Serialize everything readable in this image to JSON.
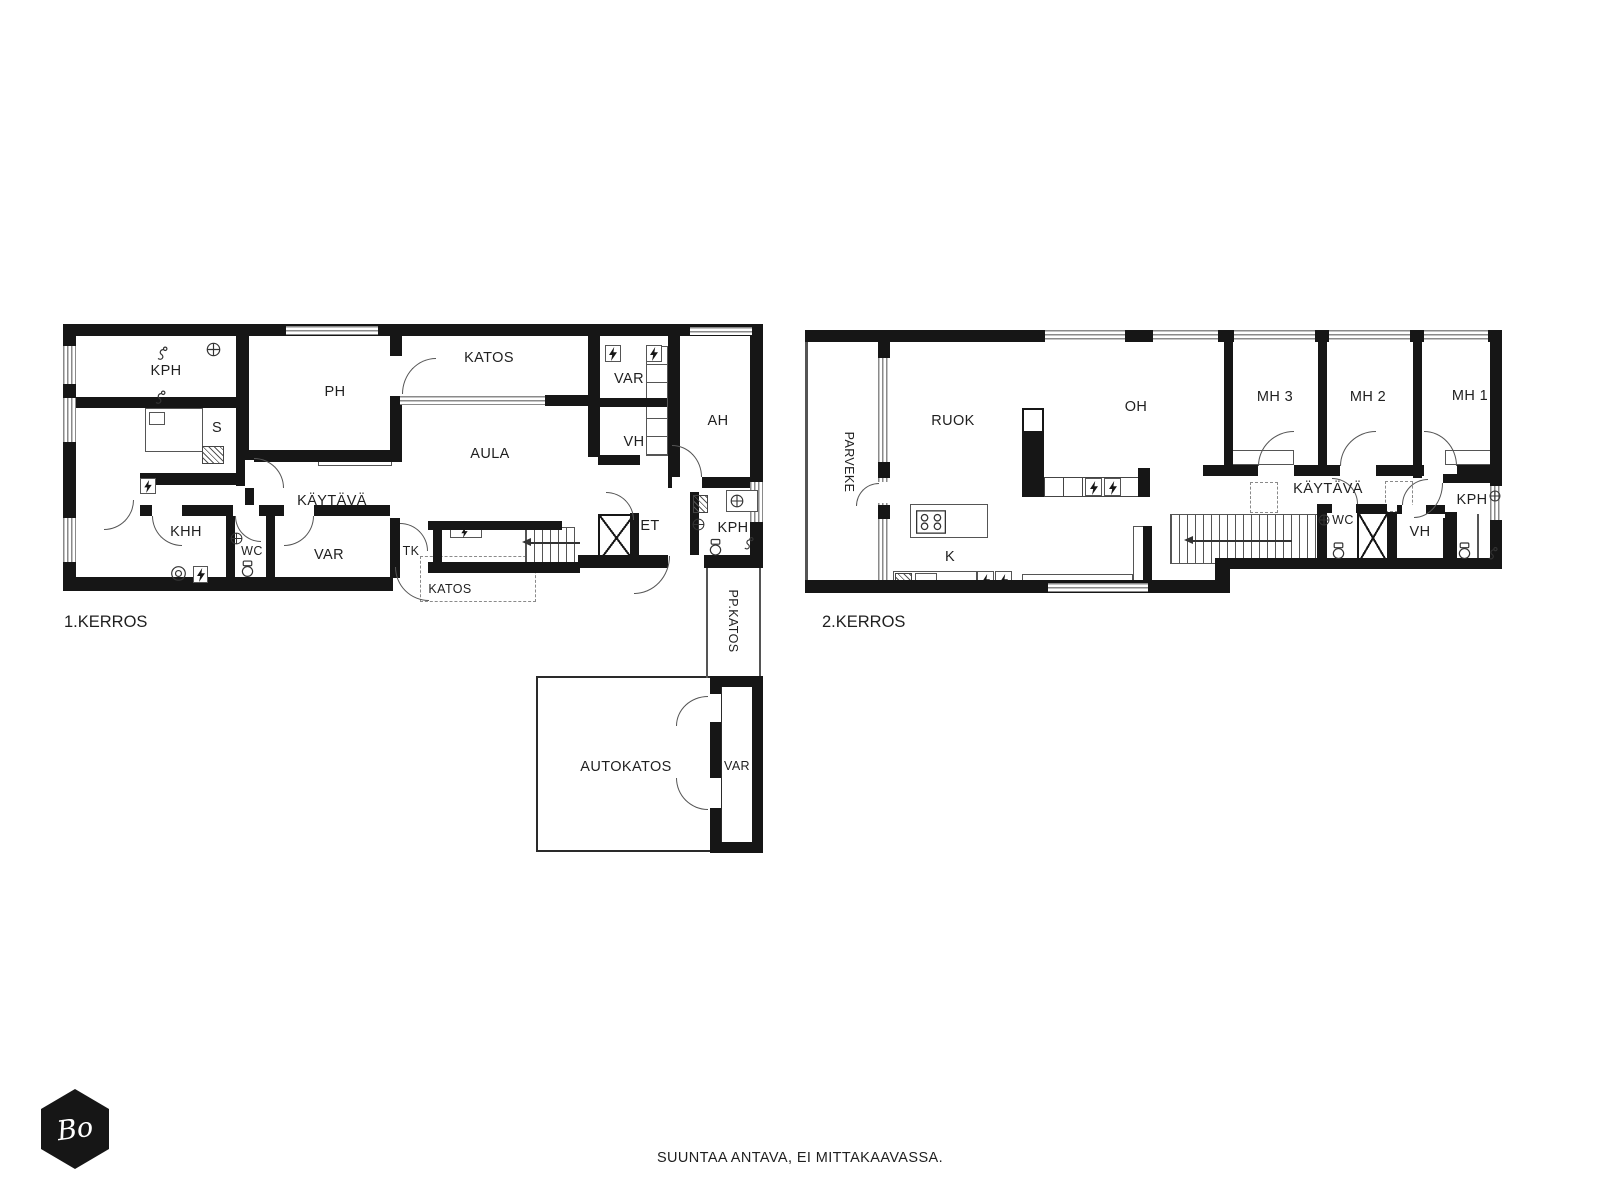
{
  "footer": {
    "note": "SUUNTAA ANTAVA, EI MITTAKAAVASSA."
  },
  "logo": {
    "text": "Bo"
  },
  "colors": {
    "wall": "#161616",
    "line": "#555555",
    "text": "#1f1f1f",
    "background": "#ffffff"
  },
  "icons": {
    "lightning-icon": "svg-bolt-in-box (electrical cabinet)",
    "toilet-icon": "svg-toilet-outline",
    "sink-icon": "svg-circle-with-cross",
    "shower-icon": "svg-hand-shower",
    "stove-icon": "svg-four-burner-cooktop",
    "washer-icon": "svg-round-drum-appliance",
    "stairs-arrow-icon": "left-arrow (ascent direction)",
    "elevator-x-icon": "crossed-box shaft"
  },
  "floor1": {
    "title": "1.KERROS",
    "rooms": {
      "kph": "KPH",
      "sauna": "S",
      "ph": "PH",
      "katos_top": "KATOS",
      "var_top": "VAR",
      "vh": "VH",
      "ah": "AH",
      "aula": "AULA",
      "kaytava": "KÄYTÄVÄ",
      "khh": "KHH",
      "wc": "WC",
      "var_mid": "VAR",
      "tk": "TK",
      "et": "ET",
      "kph2": "KPH",
      "katos_bottom": "KATOS",
      "pp_katos": "PP.KATOS",
      "autokatos": "AUTOKATOS",
      "var_bottom": "VAR"
    }
  },
  "floor2": {
    "title": "2.KERROS",
    "rooms": {
      "parveke": "PARVEKE",
      "ruok": "RUOK",
      "oh": "OH",
      "mh3": "MH 3",
      "mh2": "MH 2",
      "mh1": "MH 1",
      "kaytava": "KÄYTÄVÄ",
      "k": "K",
      "wc": "WC",
      "vh": "VH",
      "kph": "KPH"
    }
  }
}
